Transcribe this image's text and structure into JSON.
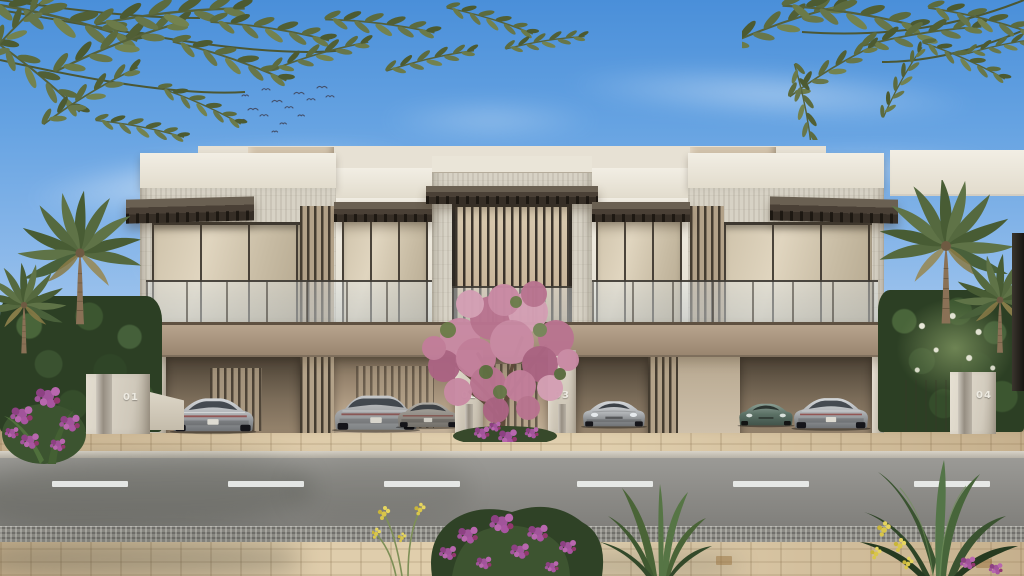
{
  "scene": {
    "title": "Modern townhouse row - exterior architectural rendering",
    "units": [
      {
        "label": "01"
      },
      {
        "label": "02"
      },
      {
        "label": "03"
      },
      {
        "label": "04"
      }
    ],
    "vehicles": [
      {
        "name": "sports-car",
        "color": "silver",
        "orientation": "rear"
      },
      {
        "name": "sedan",
        "color": "silver",
        "orientation": "rear"
      },
      {
        "name": "sports-car",
        "color": "grey",
        "orientation": "rear"
      },
      {
        "name": "sports-car",
        "color": "silver",
        "orientation": "front"
      },
      {
        "name": "sports-car",
        "color": "green",
        "orientation": "front"
      },
      {
        "name": "sports-car",
        "color": "silver",
        "orientation": "rear"
      }
    ],
    "road": {
      "lane_dash_count": 6,
      "dash_color": "#eef0ee"
    },
    "palette": {
      "sky_top": "#4a8fd9",
      "sky_horizon": "#e7f0f9",
      "facade_cream": "#f2eee4",
      "facade_stone": "#d7d2c5",
      "roof_taupe": "#c3b29a",
      "metal_bronze": "#4a4036",
      "podium_taupe": "#a8957e",
      "glass_warm": "#d6c9b2",
      "paver_beige": "#d9c6a5",
      "road_grey": "#8b8a86",
      "palm_green": "#55693f",
      "hedge_green": "#2c3f24",
      "bloom_pink": "#c98aa4",
      "flower_magenta": "#a84f86",
      "flower_yellow": "#d9c64a"
    }
  }
}
